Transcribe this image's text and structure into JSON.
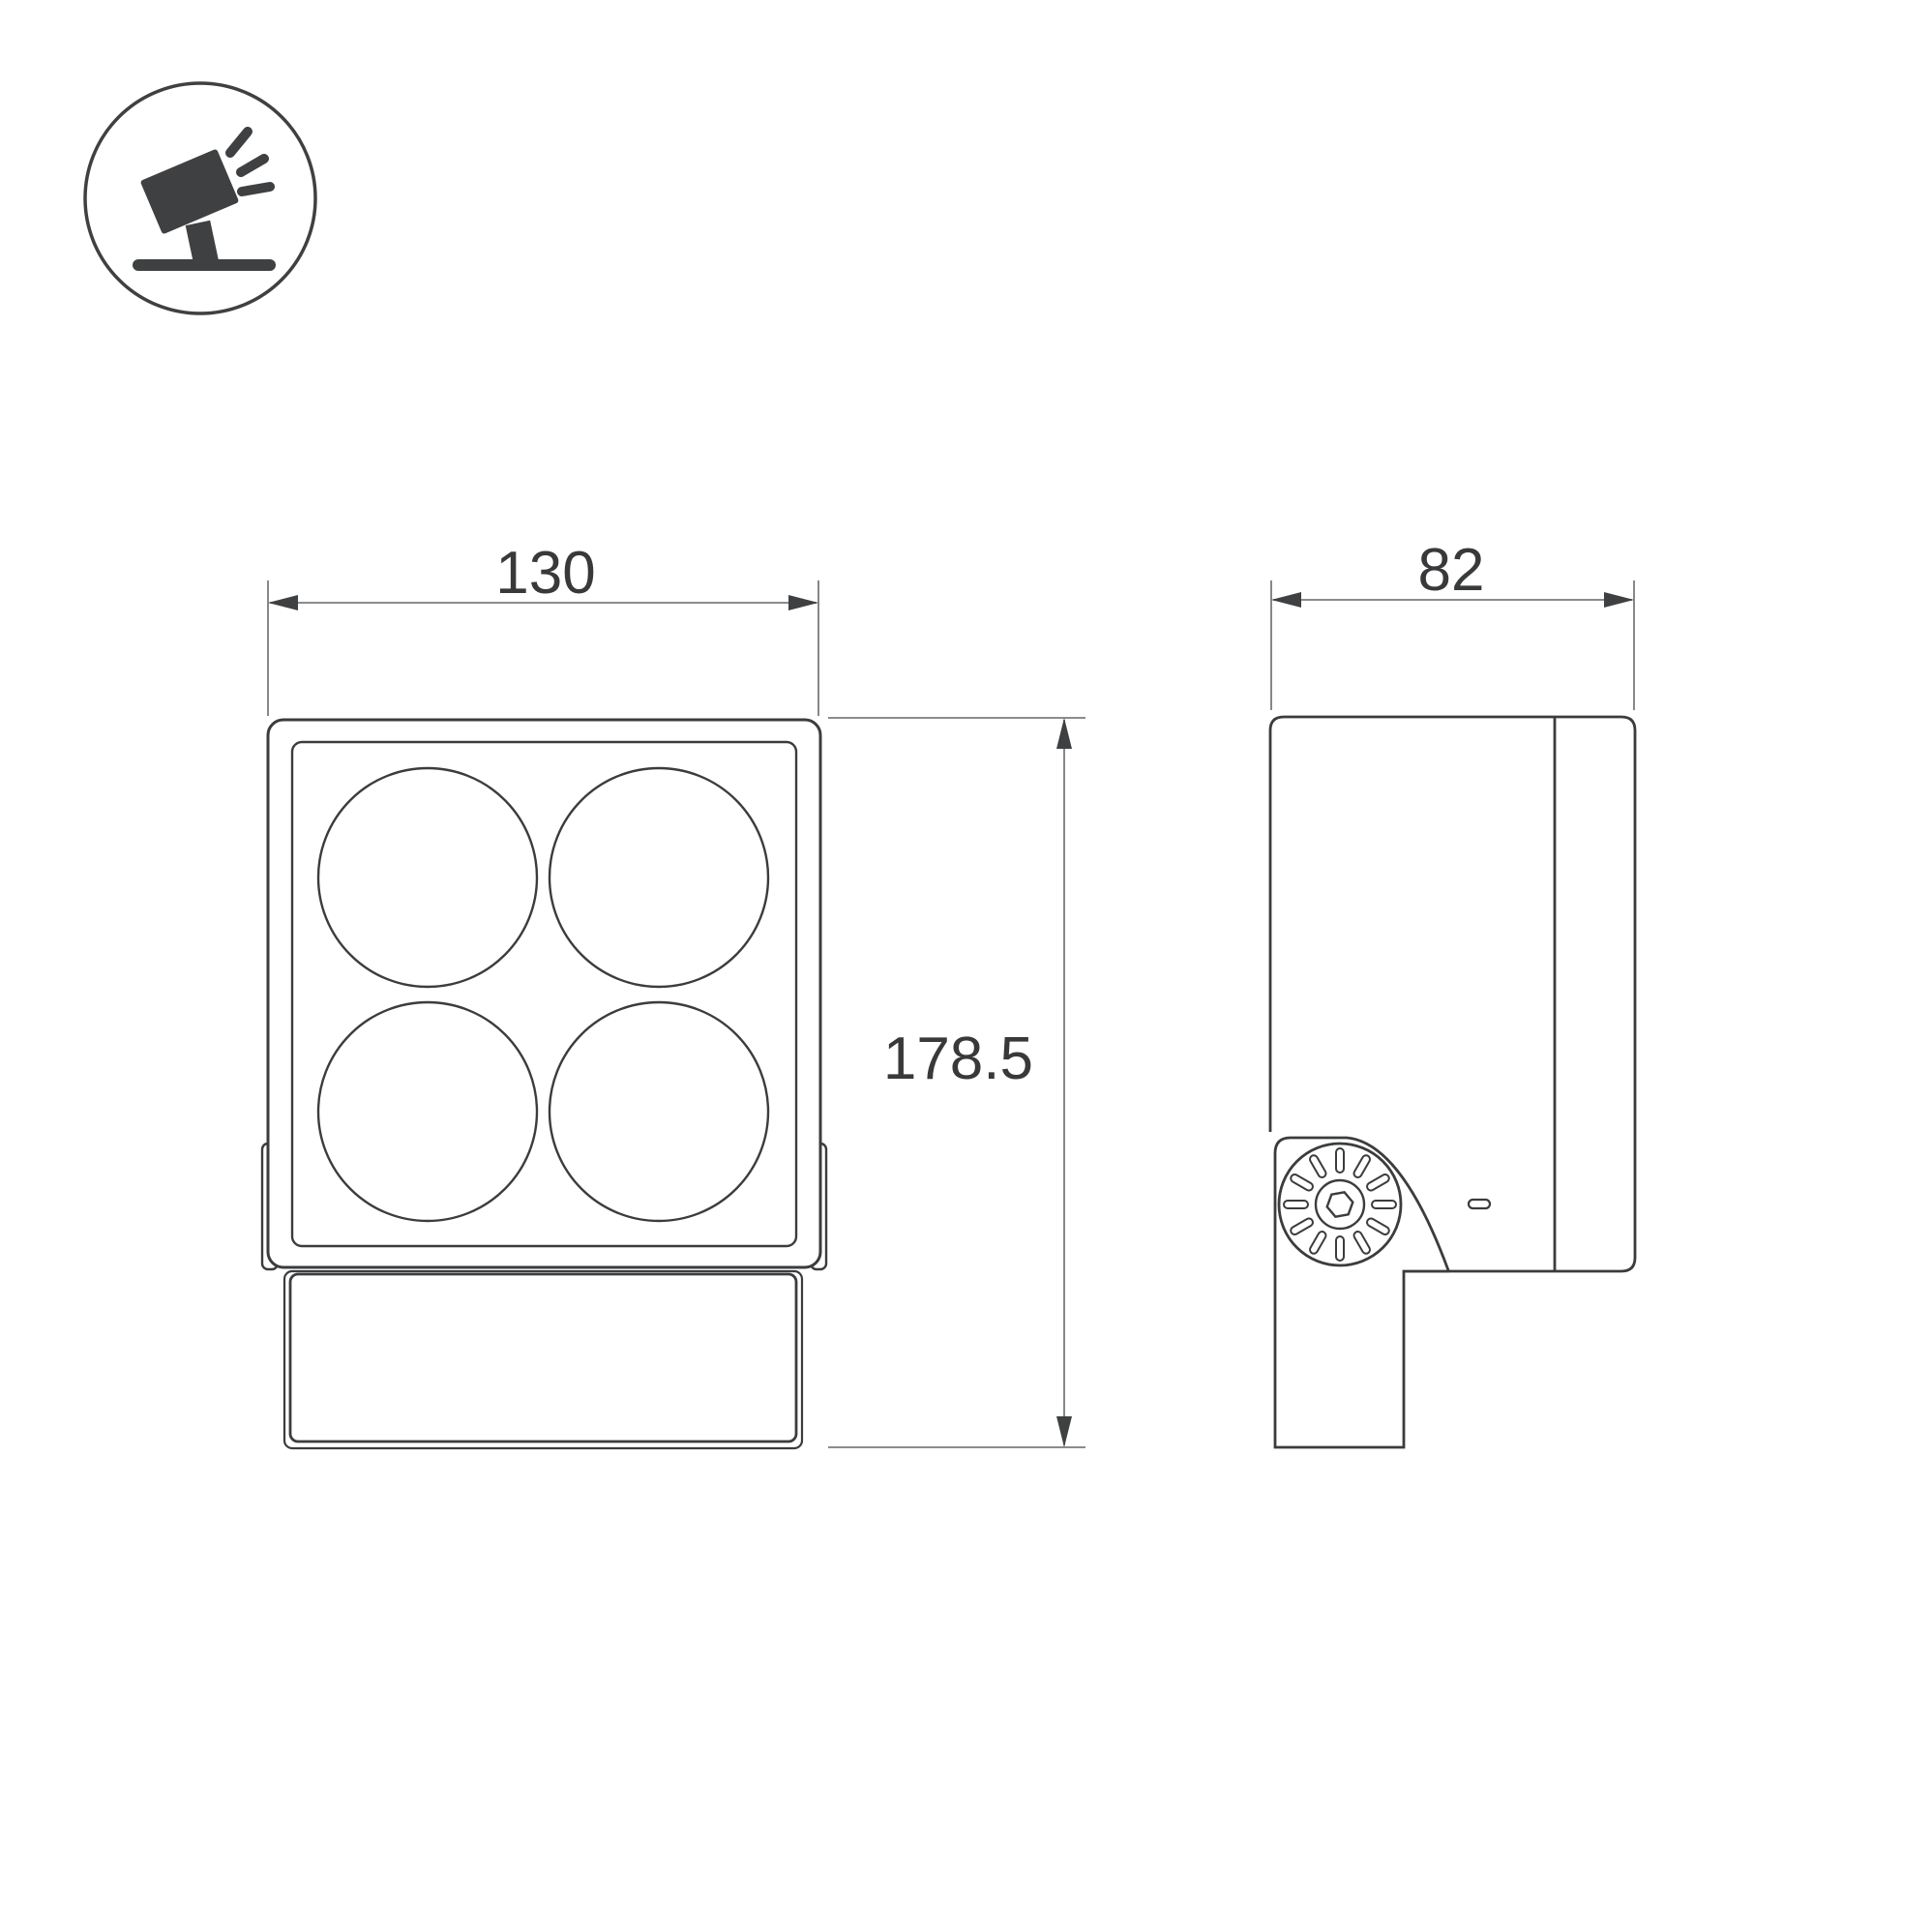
{
  "canvas": {
    "background_color": "#ffffff",
    "outline_color": "#3b3c3e",
    "dimension_line_color": "#7a7b7d",
    "label_color": "#38393a"
  },
  "icon": {
    "name": "tilted-floodlight-pictogram",
    "color": "#3f4041"
  },
  "drawing": {
    "front_view": {
      "lens_count": 4
    },
    "side_view": {
      "pivot_slot_count": 12
    },
    "dimensions": {
      "front_width": {
        "value": "130"
      },
      "overall_height": {
        "value": "178.5"
      },
      "side_depth": {
        "value": "82"
      }
    }
  }
}
